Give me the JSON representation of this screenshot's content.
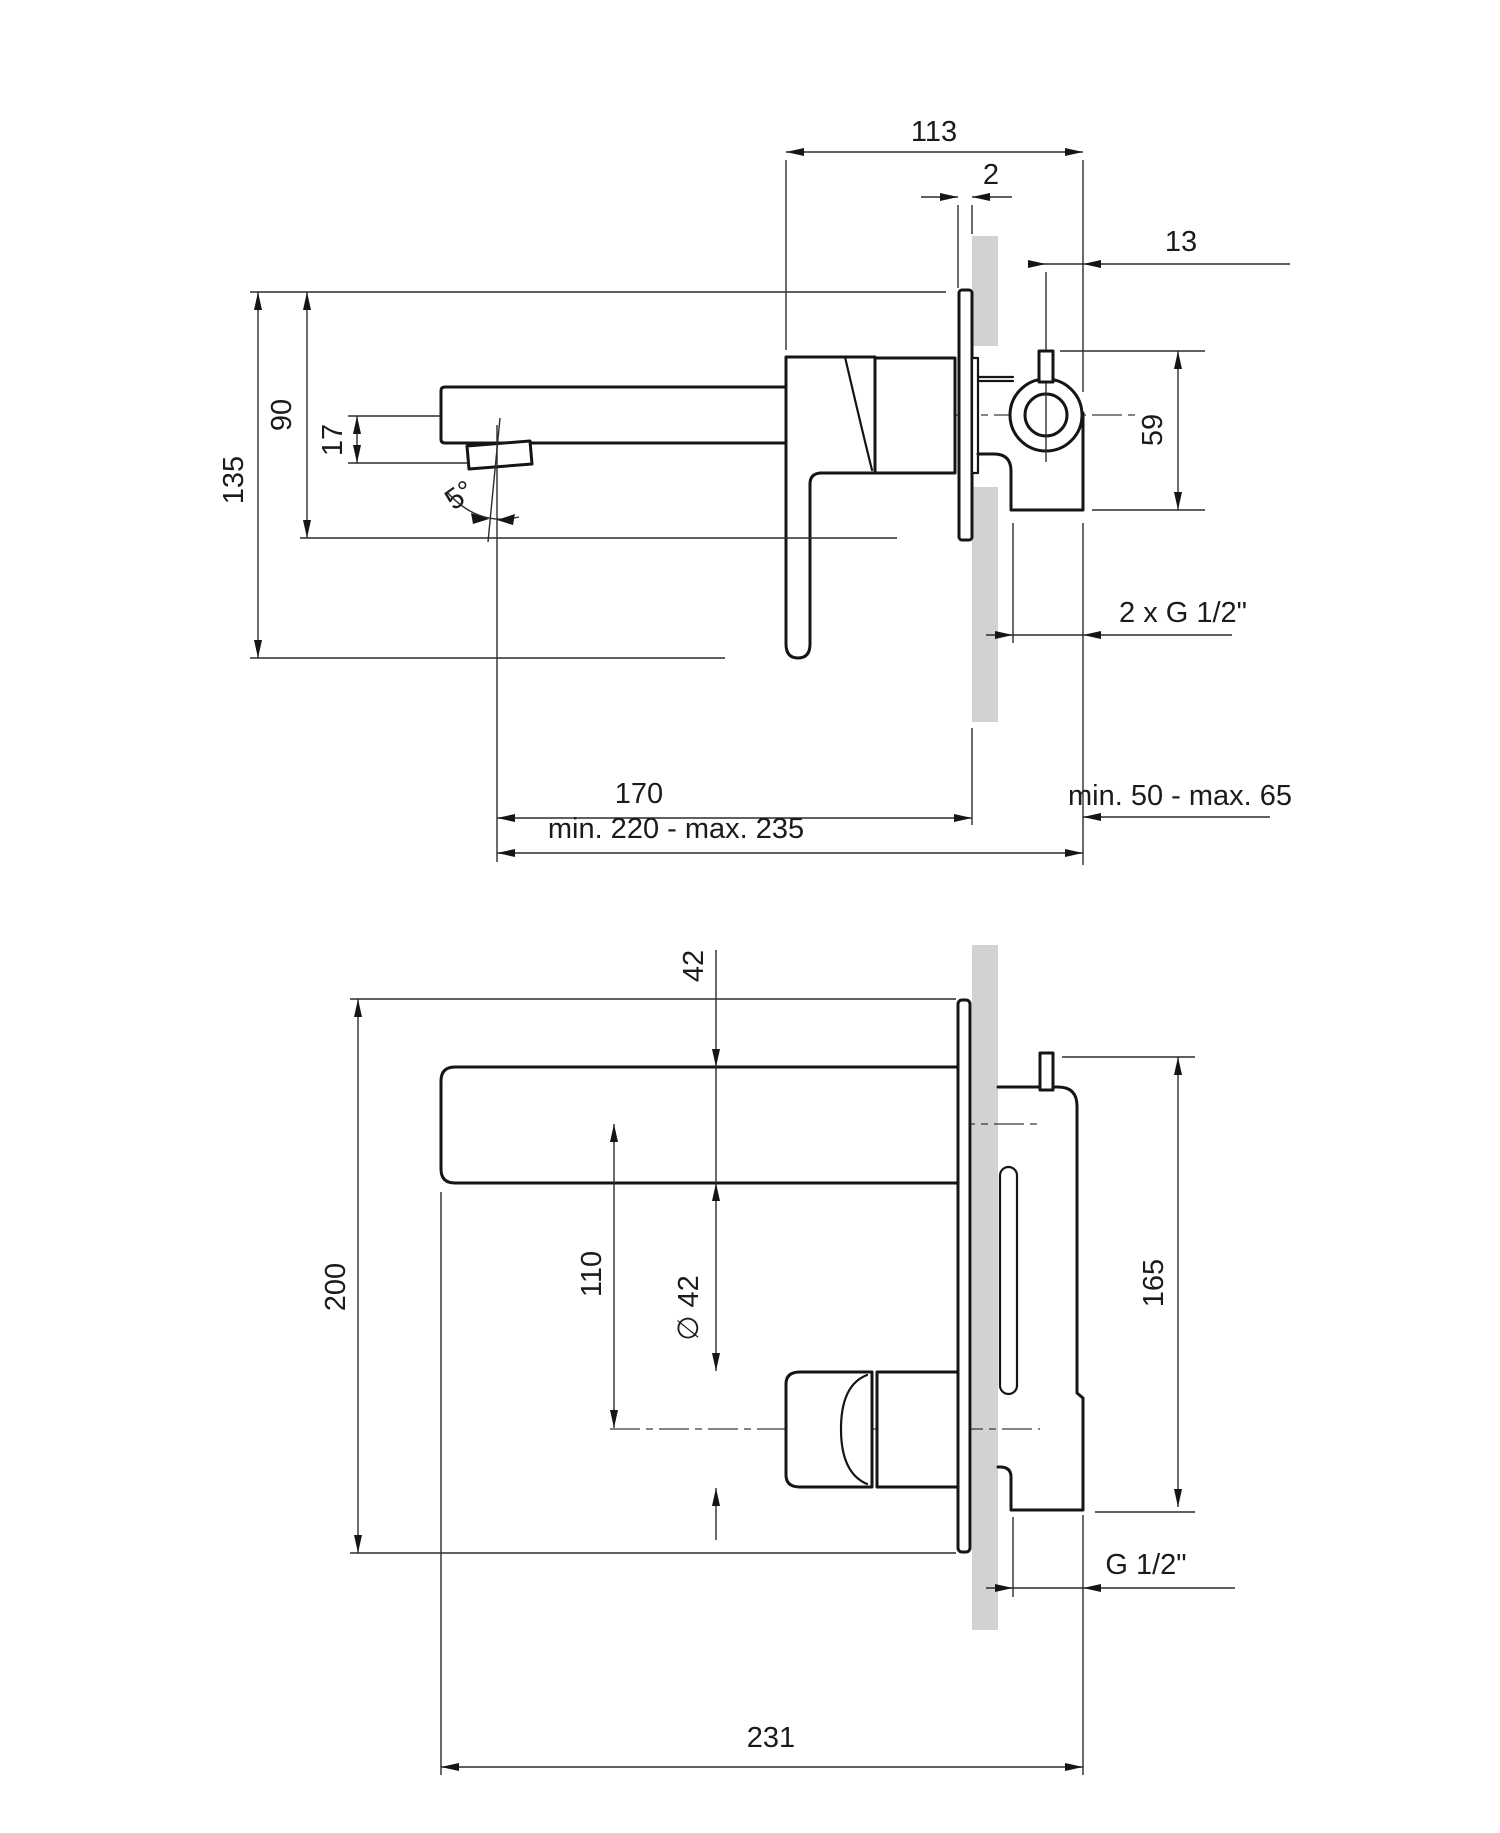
{
  "drawing": {
    "kind": "wall-mounted basin mixer installation drawing",
    "colors": {
      "line": "#151515",
      "wall_hatch": "#d2d2d2",
      "background": "#ffffff"
    },
    "side_view": {
      "dims": {
        "body_length": "113",
        "plate_gap": "2",
        "pin_offset": "13",
        "pin_drop": "59",
        "plate_height": "90",
        "total_height": "135",
        "spout_drop": "17",
        "spout_angle": "5°",
        "inlet_thread": "2 x G 1/2\"",
        "embed_depth": "min. 50 - max. 65",
        "spout_to_wall": "170",
        "spout_reach": "min. 220 - max. 235"
      }
    },
    "plan_view": {
      "dims": {
        "spout_width": "42",
        "body_diameter": "∅ 42",
        "axis_distance": "110",
        "plate_length": "200",
        "body_height": "165",
        "outlet_thread": "G 1/2\"",
        "total_length": "231"
      }
    }
  }
}
